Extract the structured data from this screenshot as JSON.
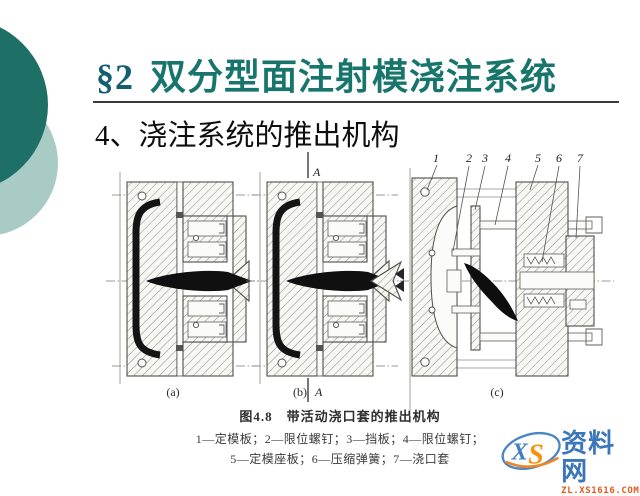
{
  "slide": {
    "title": {
      "section": "§2",
      "text": "双分型面注射模浇注系统"
    },
    "subtitle": "4、浇注系统的推出机构"
  },
  "figure": {
    "view_labels": {
      "a": "(a)",
      "b": "(b)",
      "c": "(c)"
    },
    "section_mark": "A",
    "part_numbers": [
      "1",
      "2",
      "3",
      "4",
      "5",
      "6",
      "7"
    ],
    "caption": "图4.8　带活动浇口套的推出机构",
    "legend_lines": [
      "1—定模板；2—限位螺钉；3—挡板；4—限位螺钉；",
      "5—定模座板；6—压缩弹簧；7—浇口套"
    ]
  },
  "watermark": {
    "logo_x": "X",
    "logo_s": "S",
    "site_name": "资料网",
    "site_url": "ZL.XS1616.COM"
  },
  "colors": {
    "accent_dark_circle": "#1E6F66",
    "accent_light_circle": "#A9CBC6",
    "title_teal": "#17756C",
    "title_section_teal": "#135F70",
    "watermark_blue": "#3B76BB",
    "watermark_orange": "#E2571B"
  }
}
